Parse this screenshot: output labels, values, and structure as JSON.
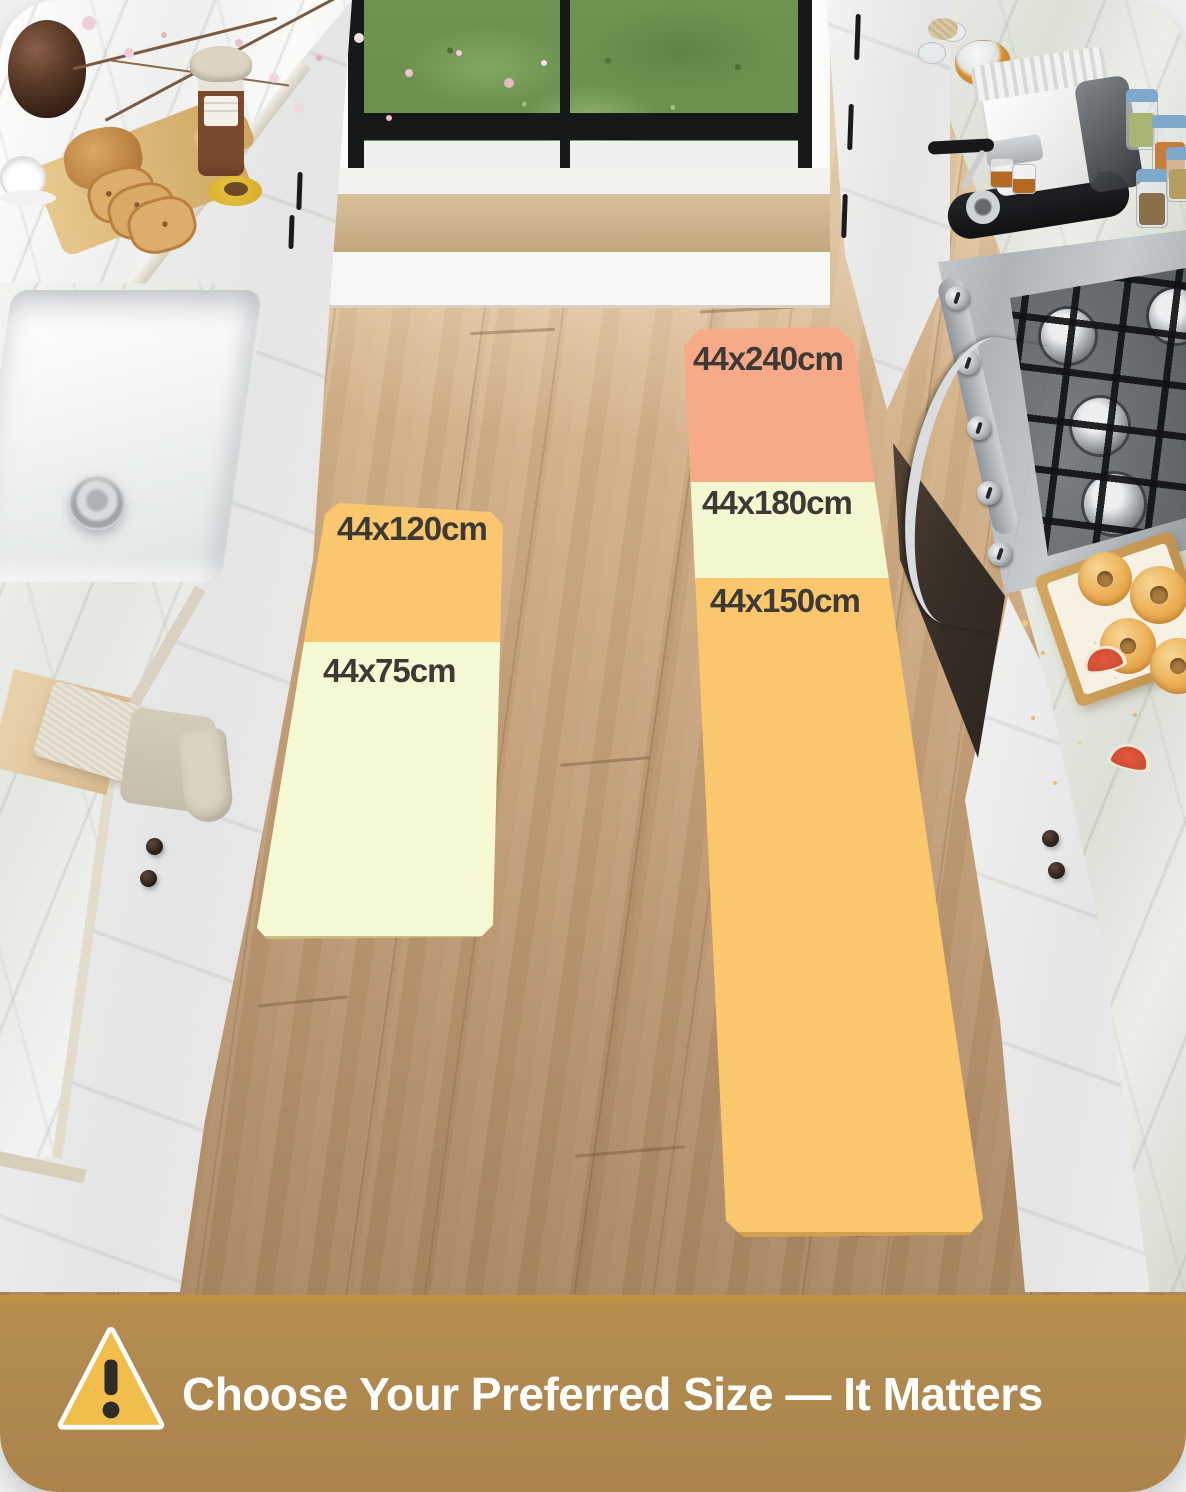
{
  "card": {
    "mats": {
      "left_runner": {
        "sections": [
          {
            "label": "44x120cm",
            "color": "#FAC76E"
          },
          {
            "label": "44x75cm",
            "color": "#F4F8D3"
          }
        ]
      },
      "right_runner": {
        "sections": [
          {
            "label": "44x240cm",
            "color": "#F7AA88"
          },
          {
            "label": "44x180cm",
            "color": "#F2F7CF"
          },
          {
            "label": "44x150cm",
            "color": "#FBC76C"
          }
        ]
      },
      "label_text_color": "#3D3935"
    },
    "banner": {
      "text": "Choose Your Preferred Size — It Matters",
      "background_color": "#B0894F",
      "text_color": "#FFFFFF",
      "icon": "warning-triangle",
      "icon_fill": "#F1BE4B"
    }
  }
}
